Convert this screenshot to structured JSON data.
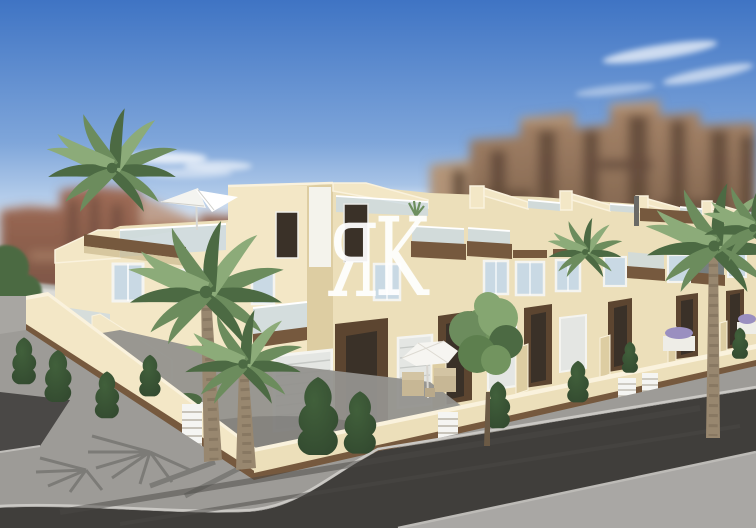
{
  "scene": {
    "type": "architectural-3d-render",
    "description": "New-build two-storey cream townhouse complex with rooftop solariums, glass balconies, wooden trim, palm trees, front patios with parasols and wicker chairs, cream perimeter wall with white slatted gates, grey sidewalk and dark asphalt street; blurred tan apartment blocks behind under a blue sky",
    "watermark": {
      "text": "ЯK",
      "letters": [
        "Я",
        "K"
      ]
    },
    "objects": {
      "sky": "blue sky with wispy clouds",
      "background_left": "blurred reddish apartment blocks",
      "background_right": "blurred tan apartment blocks",
      "main_building": "cream townhouse row with roof terraces",
      "palms": "canary palms",
      "street": "asphalt road with grey sidewalks"
    }
  },
  "colors": {
    "sky_top": "#3f74c4",
    "sky_mid": "#7fa6da",
    "sky_horizon": "#d7e6f5",
    "cloud": "#ffffff",
    "bgl": "#a06c56",
    "bgl_dark": "#6e4c3f",
    "bgl_light": "#b98f74",
    "bgr": "#a8866a",
    "bgr_dark": "#5f4837",
    "bgr_light": "#c0a285",
    "wall_bright": "#f3e7c6",
    "wall_lit": "#ecdfba",
    "wall_shade": "#ddcda2",
    "coping": "#faf2dd",
    "wood": "#76593e",
    "wood_dark": "#5c4530",
    "door_dark": "#3a3128",
    "glass": "#c9d9e4",
    "frame": "#f4f4f0",
    "shutter": "#e4e6e3",
    "palm_dark": "#4c6a43",
    "palm_mid": "#6c8c5d",
    "palm_light": "#8cab79",
    "trunk": "#98876f",
    "trunk_ring": "#7c6c57",
    "conifer": "#31472e",
    "conifer_light": "#41603b",
    "tree": "#72945f",
    "road": "#403e3b",
    "sidewalk": "#9d9b97",
    "pavement": "#a9a7a4",
    "curb": "#cac8c4",
    "white_side": "#dcdcd8",
    "watermark": "#ffffff"
  }
}
